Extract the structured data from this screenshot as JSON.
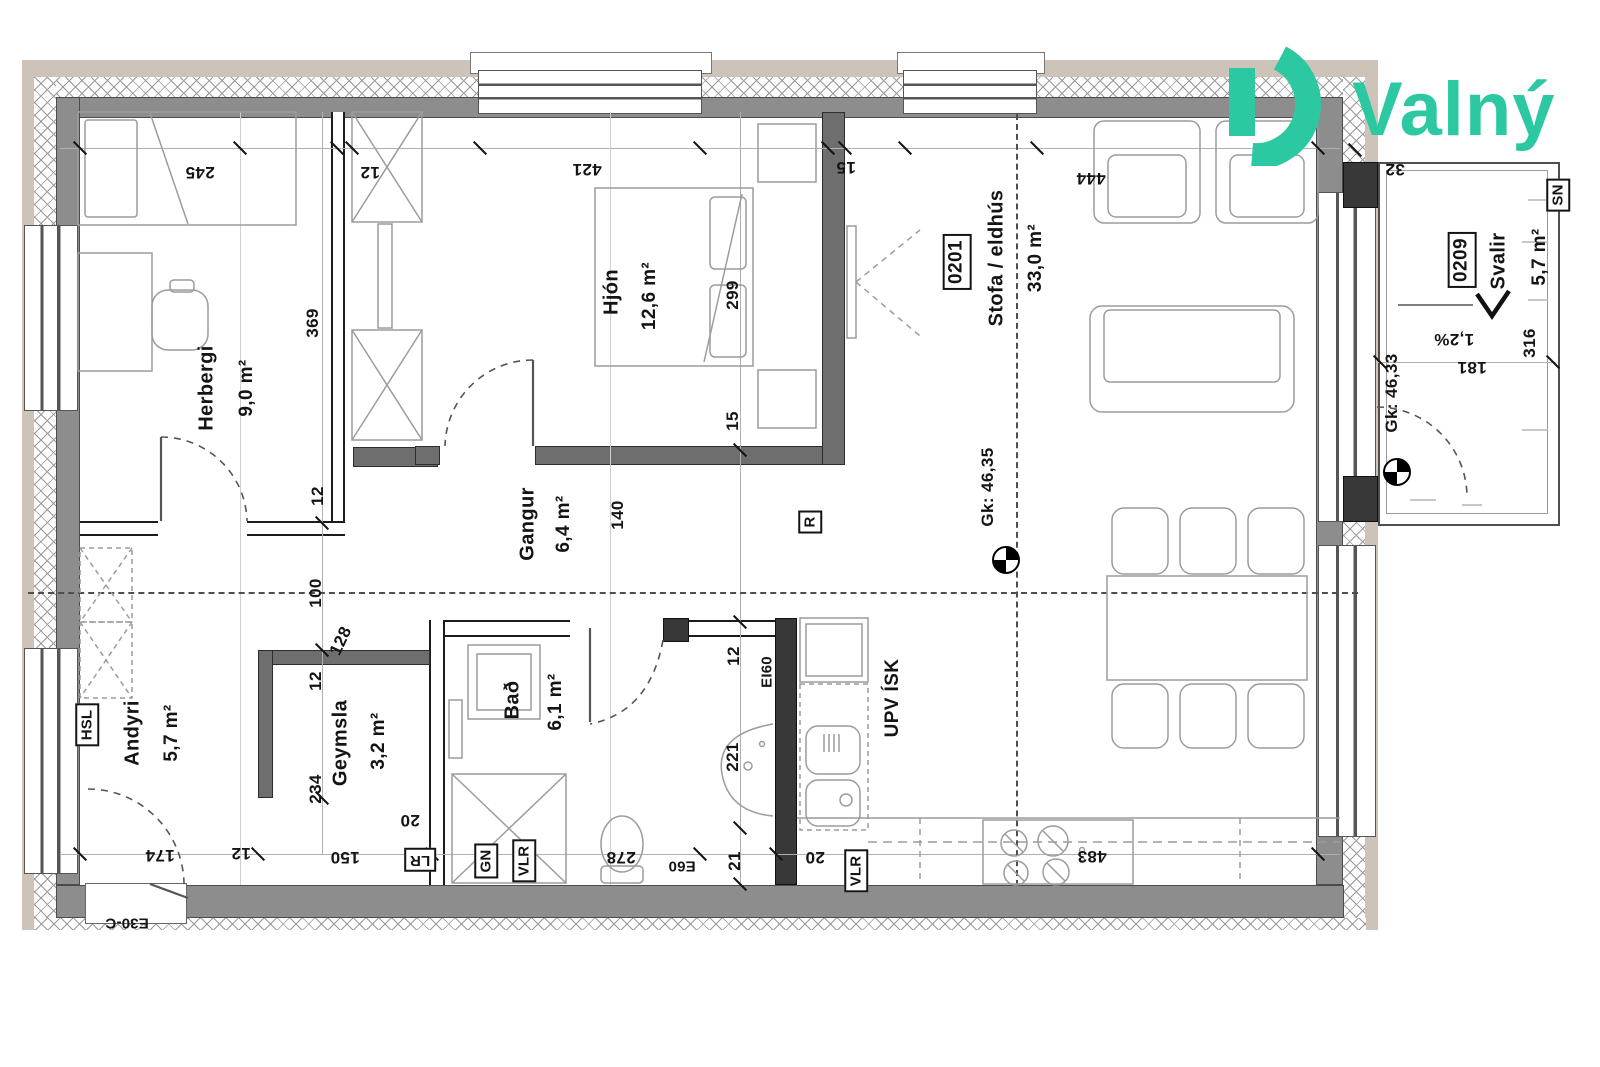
{
  "brand": {
    "name": "Valný",
    "accent": "#2cc8a1"
  },
  "rooms": {
    "herbergi": {
      "name": "Herbergi",
      "area": "9,0 m²"
    },
    "hjon": {
      "name": "Hjón",
      "area": "12,6 m²"
    },
    "gangur": {
      "name": "Gangur",
      "area": "6,4 m²"
    },
    "stofa": {
      "unit": "0201",
      "name": "Stofa / eldhús",
      "area": "33,0 m²"
    },
    "svalir": {
      "unit": "0209",
      "name": "Svalir",
      "area": "5,7 m²"
    },
    "andyri": {
      "name": "Andyri",
      "area": "5,7 m²"
    },
    "geymsla": {
      "name": "Geymsla",
      "area": "3,2 m²"
    },
    "bad": {
      "name": "Bað",
      "area": "6,1 m²"
    }
  },
  "levels": {
    "stofa": "Gk: 46,35",
    "svalir": "Gk: 46,33",
    "slope": "1,2%"
  },
  "tags": {
    "hsl": "HSL",
    "lr": "LR",
    "gn": "GN",
    "vlr_bath": "VLR",
    "vlr_kitchen": "VLR",
    "e60": "E60",
    "ei60": "EI60",
    "e30c": "E30-C",
    "sn": "SN",
    "r": "R",
    "upv": "UPV ÍSK"
  },
  "dims": {
    "d245": "245",
    "d12a": "12",
    "d421": "421",
    "d15a": "15",
    "d444": "444",
    "d32": "32",
    "d369": "369",
    "d12b": "12",
    "d299": "299",
    "d15b": "15",
    "d140": "140",
    "d100": "100",
    "d128": "128",
    "d12c": "12",
    "d234": "234",
    "d20a": "20",
    "d174": "174",
    "d12d": "12",
    "d150": "150",
    "d278": "278",
    "d21": "21",
    "d20b": "20",
    "d483": "483",
    "d12e": "12",
    "d221": "221",
    "d316": "316",
    "d181": "181"
  }
}
